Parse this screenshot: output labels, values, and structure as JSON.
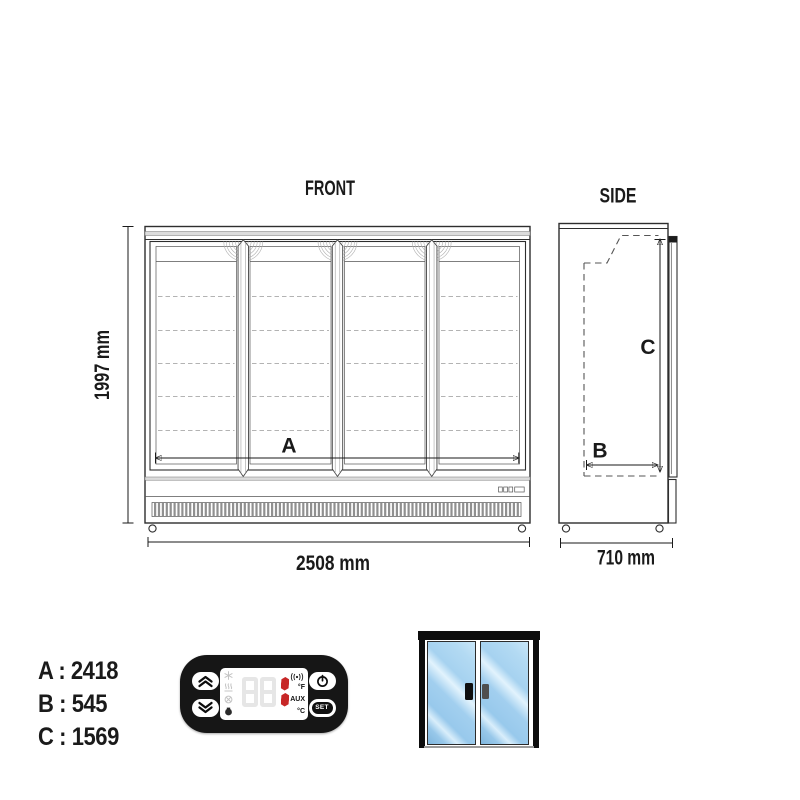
{
  "front_view": {
    "title": "FRONT",
    "height_dim": "1997 mm",
    "width_dim": "2508 mm",
    "inner_width_label": "A"
  },
  "side_view": {
    "title": "SIDE",
    "depth_dim": "710 mm",
    "inner_depth_label": "B",
    "inner_height_label": "C"
  },
  "legend": {
    "separator": " : ",
    "rows": [
      {
        "key": "A",
        "value": "2418"
      },
      {
        "key": "B",
        "value": "545"
      },
      {
        "key": "C",
        "value": "1569"
      }
    ]
  },
  "controller": {
    "set_button": "SET",
    "unit_f": "°F",
    "aux_label": "AUX",
    "unit_c": "°C",
    "display_value": "1",
    "body_color": "#161616",
    "segment_off_color": "#e6e6e6",
    "segment_on_color": "#c72727",
    "icons": [
      "up-arrows-icon",
      "down-arrows-icon",
      "power-icon",
      "snowflake-icon",
      "defrost-icon",
      "fan-icon",
      "compressor-icon",
      "signal-icon"
    ]
  },
  "fridge_icon": {
    "frame_color": "#0d0d0d",
    "glass_color": "#9ccbee",
    "left_handle_color": "#0f0f0f",
    "right_handle_color": "#4f4f4f"
  }
}
